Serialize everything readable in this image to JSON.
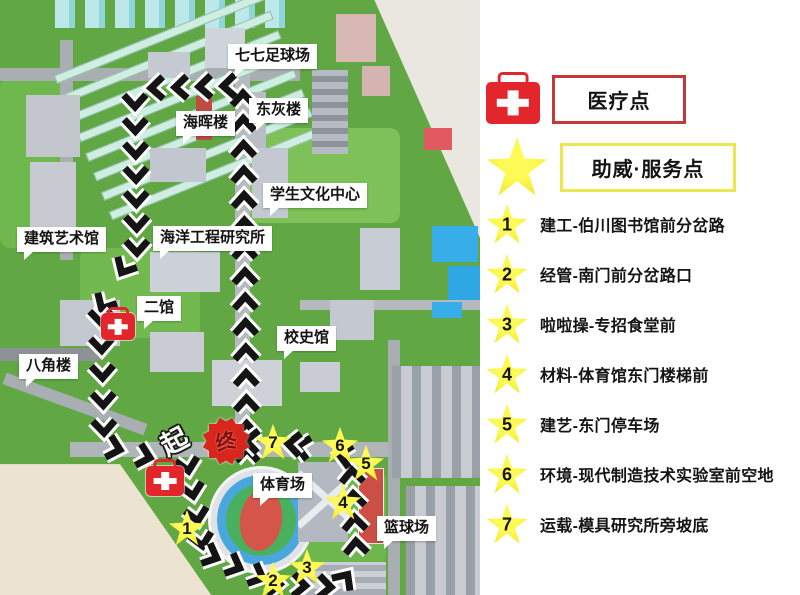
{
  "panel": {
    "legend": [
      {
        "icon": "first-aid-kit-icon",
        "label": "医疗点"
      },
      {
        "icon": "star-icon",
        "label": "助威·服务点"
      }
    ],
    "points": [
      {
        "num": "1",
        "label": "建工-伯川图书馆前分岔路"
      },
      {
        "num": "2",
        "label": "经管-南门前分岔路口"
      },
      {
        "num": "3",
        "label": "啦啦操-专招食堂前"
      },
      {
        "num": "4",
        "label": "材料-体育馆东门楼梯前"
      },
      {
        "num": "5",
        "label": "建艺-东门停车场"
      },
      {
        "num": "6",
        "label": "环境-现代制造技术实验室前空地"
      },
      {
        "num": "7",
        "label": "运载-模具研究所旁坡底"
      }
    ]
  },
  "map": {
    "labels": [
      "七七足球场",
      "东灰楼",
      "海晖楼",
      "学生文化中心",
      "建筑艺术馆",
      "海洋工程研究所",
      "二馆",
      "校史馆",
      "八角楼",
      "体育场",
      "篮球场"
    ],
    "start_marker": "起",
    "finish_marker": "终",
    "star_numbers": [
      "1",
      "2",
      "3",
      "4",
      "5",
      "6",
      "7"
    ]
  },
  "colors": {
    "medical_red": "#e2262b",
    "legend_red_border": "#c5383a",
    "star_yellow": "#f1e92c",
    "legend_yellow_border": "#ece74c",
    "chevron_black": "#141414",
    "map_green": "#61a845"
  }
}
